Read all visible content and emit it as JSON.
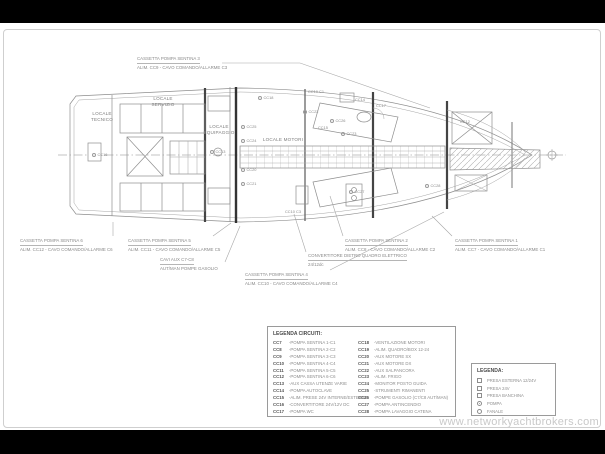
{
  "watermark": "www.networkyachtbrokers.com",
  "plan": {
    "rooms": [
      {
        "text": "LOCALE\nTECNICO"
      },
      {
        "text": "LOCALE\nSERVIZIO"
      },
      {
        "text": "LOCALE\nEQUIPAGGIO"
      },
      {
        "text": "LOCALE MOTORI"
      }
    ],
    "centerline_symbol": "⊕",
    "markers": [
      {
        "label": "CC16",
        "x": 92,
        "y": 152,
        "type": "circ"
      },
      {
        "label": "CC13",
        "x": 210,
        "y": 149,
        "type": "circ"
      },
      {
        "label": "CC18",
        "x": 258,
        "y": 95,
        "type": "circ"
      },
      {
        "label": "CC19 C1",
        "x": 308,
        "y": 89,
        "type": "text"
      },
      {
        "label": "CC26",
        "x": 330,
        "y": 118,
        "type": "circ"
      },
      {
        "label": "CC23",
        "x": 341,
        "y": 131,
        "type": "circ"
      },
      {
        "label": "CC25",
        "x": 241,
        "y": 124,
        "type": "circ"
      },
      {
        "label": "CC24",
        "x": 241,
        "y": 138,
        "type": "circ"
      },
      {
        "label": "CC20",
        "x": 241,
        "y": 167,
        "type": "circ"
      },
      {
        "label": "CC21",
        "x": 241,
        "y": 181,
        "type": "circ"
      },
      {
        "label": "CC22",
        "x": 303,
        "y": 109,
        "type": "circ"
      },
      {
        "label": "CC14",
        "x": 355,
        "y": 97,
        "type": "text"
      },
      {
        "label": "CC17",
        "x": 376,
        "y": 103,
        "type": "text"
      },
      {
        "label": "CC15",
        "x": 318,
        "y": 125,
        "type": "text"
      },
      {
        "label": "CC27",
        "x": 349,
        "y": 189,
        "type": "circ"
      },
      {
        "label": "CC28",
        "x": 425,
        "y": 183,
        "type": "circ"
      },
      {
        "label": "CC10 C3",
        "x": 285,
        "y": 209,
        "type": "text"
      },
      {
        "label": "CC12",
        "x": 460,
        "y": 119,
        "type": "text"
      }
    ]
  },
  "callouts": [
    {
      "line1": "CASSETTA POMPA SENTINA 3",
      "line2": "ALIM. CC9 - CAVO COMANDO/ALLARME C3"
    },
    {
      "line1": "CASSETTA POMPA SENTINA 6",
      "line2": "ALIM. CC12 - CAVO COMANDO/ALLARME C6"
    },
    {
      "line1": "CASSETTA POMPA SENTINA 5",
      "line2": "ALIM. CC11 - CAVO COMANDO/ALLARME C5"
    },
    {
      "line1": "CAVI AUX C7-C8",
      "line2": "AUT/MAN POMPE GASOLIO"
    },
    {
      "line1": "CASSETTA POMPA SENTINA 4",
      "line2": "ALIM. CC10 - CAVO COMANDO/ALLARME C4"
    },
    {
      "line1": "CONVERTITORE DIETRO QUADRO ELETTRICO",
      "line2": "24/12dc"
    },
    {
      "line1": "CASSETTA POMPA SENTINA 2",
      "line2": "ALIM. CC8 - CAVO COMANDO/ALLARME C2"
    },
    {
      "line1": "CASSETTA POMPA SENTINA 1",
      "line2": "ALIM. CC7 - CAVO COMANDO/ALLARME C1"
    }
  ],
  "legend_circuits": {
    "title": "LEGENDA CIRCUITI:",
    "columns": [
      [
        {
          "code": "CC7",
          "desc": "-POMPA SENTINA 1-C1"
        },
        {
          "code": "CC8",
          "desc": "-POMPA SENTINA 2-C2"
        },
        {
          "code": "CC9",
          "desc": "-POMPA SENTINA 3-C3"
        },
        {
          "code": "CC10",
          "desc": "-POMPA SENTINA 4-C4"
        },
        {
          "code": "CC11",
          "desc": "-POMPA SENTINA 5-C5"
        },
        {
          "code": "CC12",
          "desc": "-POMPA SENTINA 6-C6"
        },
        {
          "code": "CC13",
          "desc": "-AUX CASSA UTENZE VARIE"
        },
        {
          "code": "CC14",
          "desc": "-POMPA AUTOCLAVE"
        },
        {
          "code": "CC15",
          "desc": "-ALIM. PRESE 24V INTERNE/ESTERNE"
        },
        {
          "code": "CC16",
          "desc": "-CONVERTITORE 24V/12V DC"
        },
        {
          "code": "CC17",
          "desc": "-POMPA WC"
        }
      ],
      [
        {
          "code": "CC18",
          "desc": "-VENTILAZIONE MOTORI"
        },
        {
          "code": "CC19",
          "desc": "-ALIM. QUADRO/BOX 12-24"
        },
        {
          "code": "CC20",
          "desc": "-AUX MOTORE SX"
        },
        {
          "code": "CC21",
          "desc": "-AUX MOTORE DX"
        },
        {
          "code": "CC22",
          "desc": "-AUX SALPANCORA"
        },
        {
          "code": "CC23",
          "desc": "-ALIM. FRIGO"
        },
        {
          "code": "CC24",
          "desc": "-MONITOR POSTO GUIDA"
        },
        {
          "code": "CC25",
          "desc": "-STRUMENTI RIMANENTI"
        },
        {
          "code": "CC26",
          "desc": "-POMPE GASOLIO (C7/C8 AUT/MAN)"
        },
        {
          "code": "CC27",
          "desc": "-POMPA ANTINCENDIO"
        },
        {
          "code": "CC28",
          "desc": "-POMPA LAVAGGIO CATENA"
        }
      ]
    ]
  },
  "legend_symbols": {
    "title": "LEGENDA:",
    "items": [
      {
        "symbol": "square",
        "label": "PRESA ESTERNA 12/24V"
      },
      {
        "symbol": "square",
        "label": "PRESA 24V"
      },
      {
        "symbol": "square",
        "label": "PRESA BANCHINA"
      },
      {
        "symbol": "pump",
        "label": "POMPA"
      },
      {
        "symbol": "circle",
        "label": "FANALE"
      }
    ]
  }
}
